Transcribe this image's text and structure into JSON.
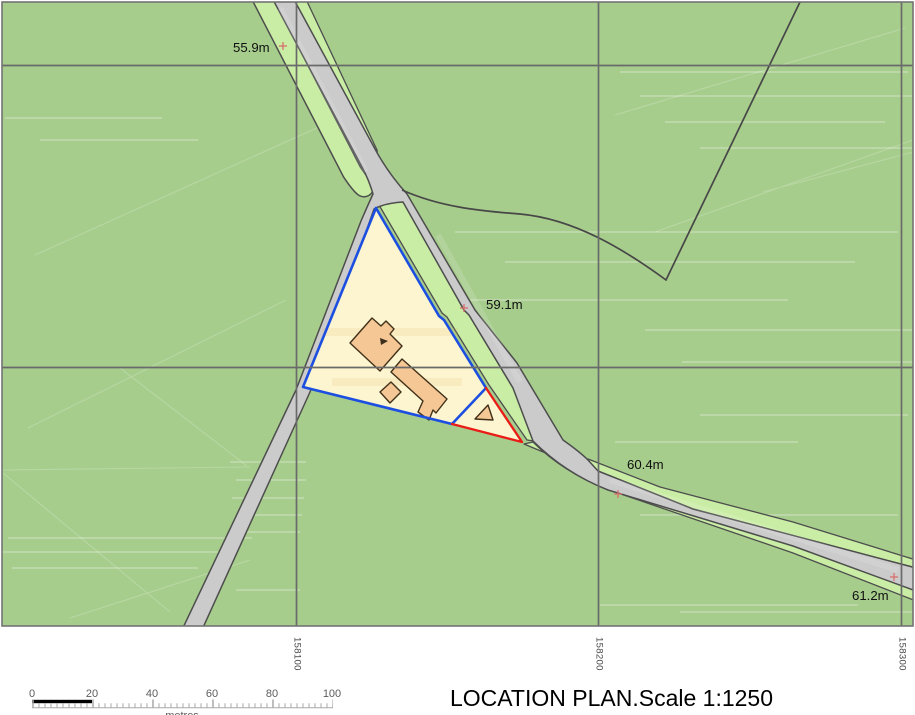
{
  "title": "LOCATION PLAN.Scale 1:1250",
  "map": {
    "spot_heights": [
      {
        "label": "55.9m"
      },
      {
        "label": "59.1m"
      },
      {
        "label": "60.4m"
      },
      {
        "label": "61.2m"
      }
    ],
    "grid_eastings": [
      {
        "label": "158100"
      },
      {
        "label": "158200"
      },
      {
        "label": "158300"
      }
    ]
  },
  "scale_bar": {
    "tick_labels": [
      "0",
      "20",
      "40",
      "60",
      "80",
      "100"
    ],
    "unit_label": "metres"
  },
  "colors": {
    "field_green": "#a7cd8d",
    "verge_green": "#c9eda5",
    "road_grey": "#cbcbcb",
    "site_cream": "#fcf5cf",
    "building_fill": "#f4c795",
    "building_outline": "#41301a",
    "boundary_blue": "#1c4fe1",
    "boundary_red": "#ea1c17",
    "outline_dark": "#4d4d4d",
    "grid_grey": "#6a6a6a",
    "spot_marker_red": "#d96b6b"
  }
}
